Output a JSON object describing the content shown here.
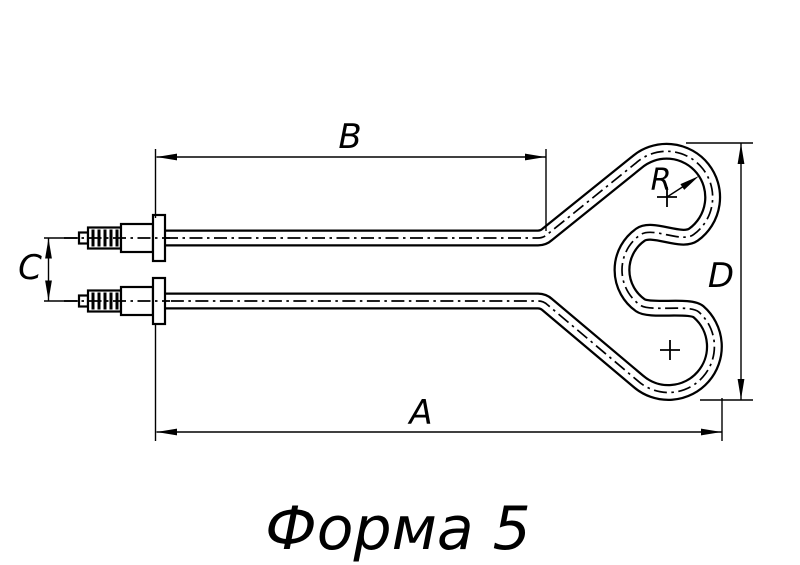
{
  "drawing": {
    "title": "Форма 5",
    "dimension_labels": {
      "overall_length": "A",
      "straight_section_length": "B",
      "terminal_spacing": "C",
      "head_height": "D",
      "bend_radius": "R"
    }
  }
}
